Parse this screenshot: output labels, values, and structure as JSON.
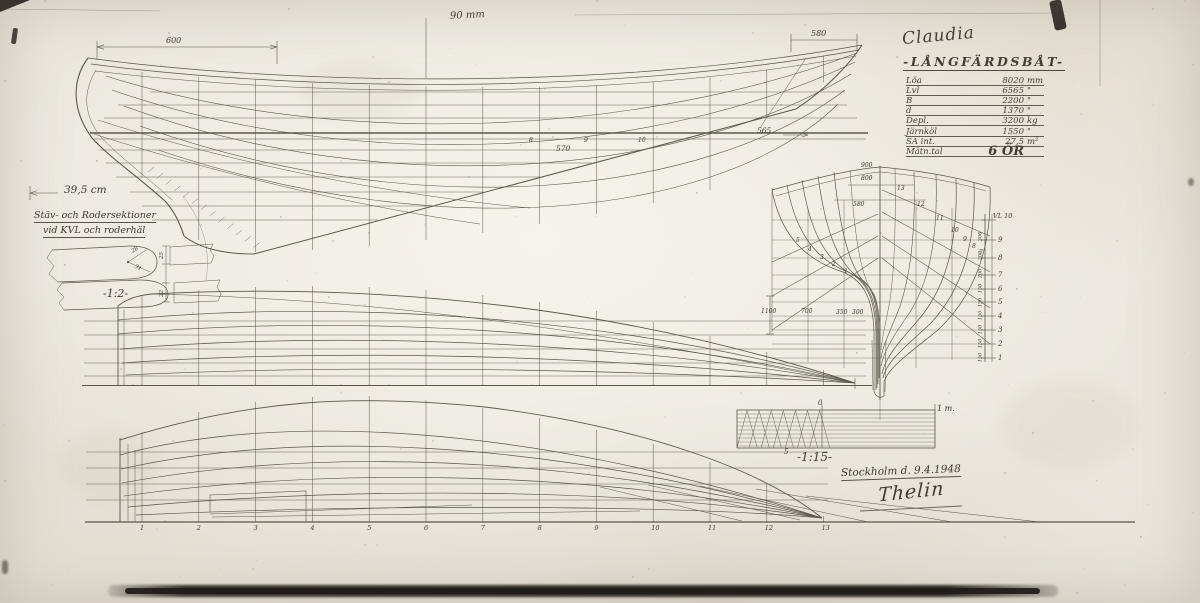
{
  "title_block": {
    "boat_name": "Claudia",
    "type_label": "-LÅNGFÄRDSBÅT-",
    "specs": [
      {
        "label": "Löa",
        "value": "8020",
        "unit": "mm"
      },
      {
        "label": "Lvl",
        "value": "6565",
        "unit": "\""
      },
      {
        "label": "B",
        "value": "2200",
        "unit": "\""
      },
      {
        "label": "d",
        "value": "1370",
        "unit": "\""
      },
      {
        "label": "Depl.",
        "value": "3200",
        "unit": "kg"
      },
      {
        "label": "Järnköl",
        "value": "1550",
        "unit": "\""
      },
      {
        "label": "SA int.",
        "value": "27,5",
        "unit": "m²"
      },
      {
        "label": "Mätn.tal",
        "value": "6 ÖR",
        "unit": ""
      }
    ]
  },
  "annotations": {
    "top_note": "90 mm",
    "dim_bow": "600",
    "dim_stern": "580",
    "dim_565": "565",
    "dim_570": "570",
    "left_measure": "39,5 cm",
    "detail_title_line1": "Stäv- och Rodersektioner",
    "detail_title_line2": "vid KVL och roderhäl",
    "detail_scale": "-1:2-",
    "detail_dims": [
      "28",
      "31",
      "25",
      "22"
    ]
  },
  "scale_bar": {
    "label": "-1:15-",
    "meter": "1 m.",
    "zero": "0",
    "five": "5"
  },
  "footer": {
    "place_date": "Stockholm d. 9.4.1948",
    "signature": "Thelin"
  },
  "body_plan": {
    "waterline_label": "VL 10",
    "waterline_numbers": [
      "9",
      "8",
      "7",
      "6",
      "5",
      "4",
      "3",
      "2",
      "1"
    ],
    "spacing_values": [
      "300",
      "200",
      "200",
      "150",
      "150",
      "150",
      "150",
      "150",
      "150"
    ],
    "top_offsets": [
      "900",
      "800",
      "580"
    ],
    "bottom_offsets": [
      "1100",
      "700",
      "350",
      "300"
    ],
    "section_numbers_fwd": [
      "13",
      "12",
      "11",
      "10",
      "9",
      "8",
      "7"
    ],
    "section_numbers_aft": [
      "5",
      "4",
      "3",
      "2",
      "1"
    ]
  },
  "stations": {
    "numbers": [
      "1",
      "2",
      "3",
      "4",
      "5",
      "6",
      "7",
      "8",
      "9",
      "10",
      "11",
      "12",
      "13"
    ],
    "lwl_marks": [
      "8",
      "9",
      "10"
    ]
  }
}
